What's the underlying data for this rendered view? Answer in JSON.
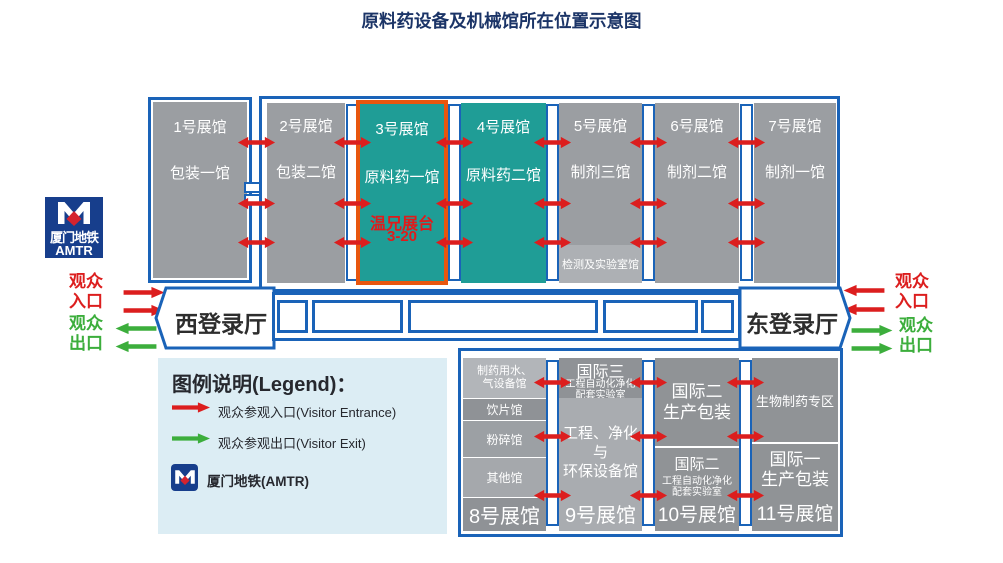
{
  "title": "原料药设备及机械馆所在位置示意图",
  "metro_logo": {
    "name_cn": "厦门地铁",
    "name_en": "AMTR"
  },
  "visitor_labels": {
    "entrance": "观众\n入口",
    "exit": "观众\n出口"
  },
  "registration_halls": {
    "west": "西登录厅",
    "east": "东登录厅"
  },
  "top_halls": [
    {
      "name": "1号展馆",
      "subtitle": "包装一馆"
    },
    {
      "name": "2号展馆",
      "subtitle": "包装二馆"
    },
    {
      "name": "3号展馆",
      "subtitle": "原料药一馆",
      "booth": "温兄展台",
      "booth_no": "3-20"
    },
    {
      "name": "4号展馆",
      "subtitle": "原料药二馆"
    },
    {
      "name": "5号展馆",
      "subtitle": "制剂三馆",
      "footer": "检测及实验室馆"
    },
    {
      "name": "6号展馆",
      "subtitle": "制剂二馆"
    },
    {
      "name": "7号展馆",
      "subtitle": "制剂一馆"
    }
  ],
  "legend": {
    "title": "图例说明(Legend)：",
    "entrance": "观众参观入口(Visitor Entrance)",
    "exit": "观众参观出口(Visitor Exit)",
    "metro": "厦门地铁(AMTR)"
  },
  "bottom_halls": {
    "hall8": {
      "sections": [
        "制药用水、\n气设备馆",
        "饮片馆",
        "粉碎馆",
        "其他馆"
      ],
      "name": "8号展馆"
    },
    "hall9": {
      "header_title": "国际三",
      "header_line1": "工程自动化净化",
      "header_line2": "配套实验室",
      "body": "工程、净化与\n环保设备馆",
      "name": "9号展馆"
    },
    "hall10": {
      "top": "国际二\n生产包装",
      "bottom_title": "国际二",
      "bottom_line1": "工程自动化净化",
      "bottom_line2": "配套实验室",
      "name": "10号展馆"
    },
    "hall11": {
      "top": "生物制药专区",
      "bottom": "国际一\n生产包装",
      "name": "11号展馆"
    }
  },
  "colors": {
    "border_blue": "#1A63B8",
    "hall_gray": "#9B9EA2",
    "hall_teal": "#1F9D96",
    "highlight_orange": "#E8560E",
    "arrow_red": "#DC1E1E",
    "arrow_green": "#3CAE3C",
    "title_navy": "#1B3467",
    "legend_bg": "#DCEDF4",
    "metro_blue": "#173E8C",
    "booth_red": "#E01B1B"
  }
}
